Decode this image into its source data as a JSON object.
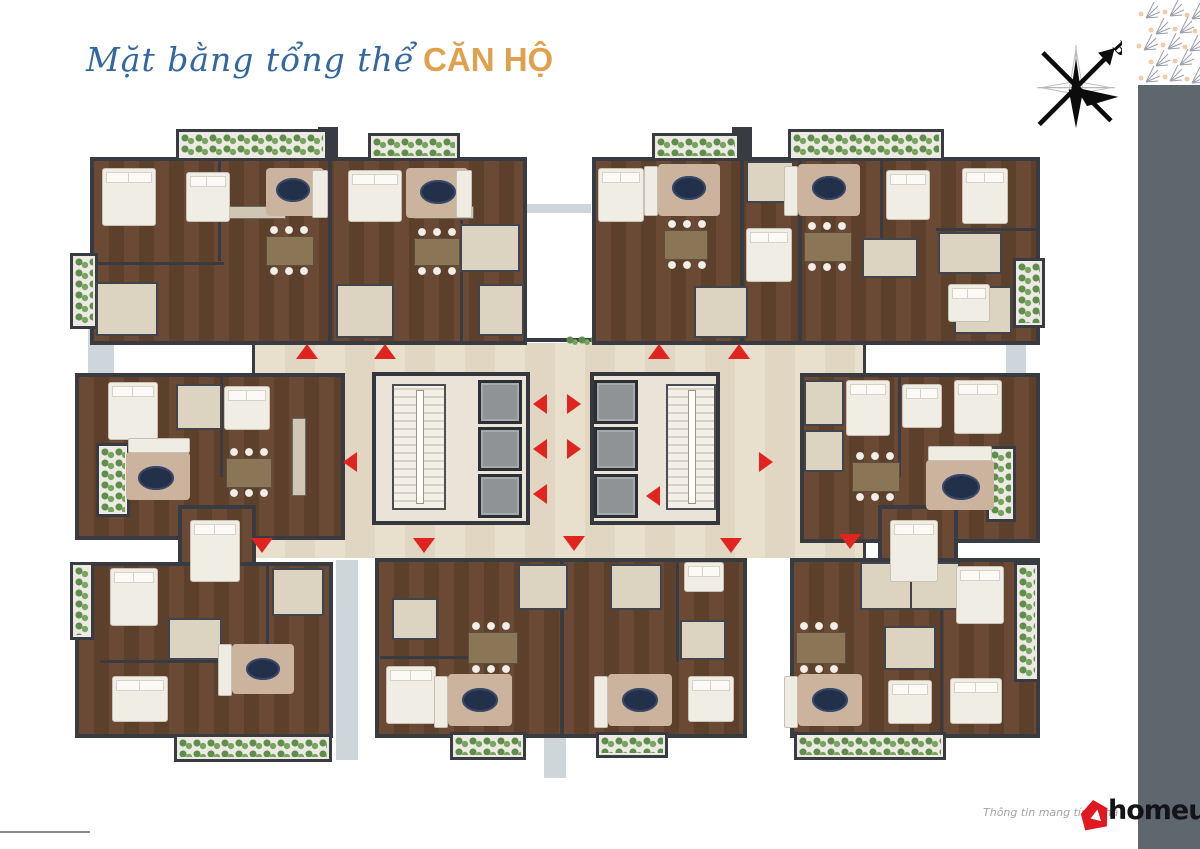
{
  "page": {
    "background_color": "#ffffff",
    "right_bar_color": "#5e676e"
  },
  "header": {
    "title_script": "Mặt bằng tổng thể",
    "title_accent": "CĂN HỘ",
    "title_script_color": "#33679f",
    "title_accent_color": "#dfa14e"
  },
  "compass": {
    "north_label": "B"
  },
  "floorplan": {
    "kind": "apartment-floor-plan-render",
    "colors": {
      "walls": "#383b42",
      "wood_floor": "#64462f",
      "light_rooms": "#ddd3c1",
      "corridor": "#e5dcc8",
      "entry_arrows": "#e02520",
      "balcony_plants": "#5f8d4b",
      "elevators": "#909396",
      "oval_rug": "#223049",
      "area_rug": "#cbb39e",
      "slab_strips": "#cfd6db"
    }
  },
  "footer": {
    "disclaimer_visible": "Thông tin mang tính chấ",
    "brand": "homeup",
    "brand_color": "#141418",
    "brand_house_color": "#e0181f"
  },
  "decor": {
    "pattern": "fan-motif-grid",
    "motif_gray": "#9aa0a8",
    "motif_peach": "#f4c9a4"
  }
}
